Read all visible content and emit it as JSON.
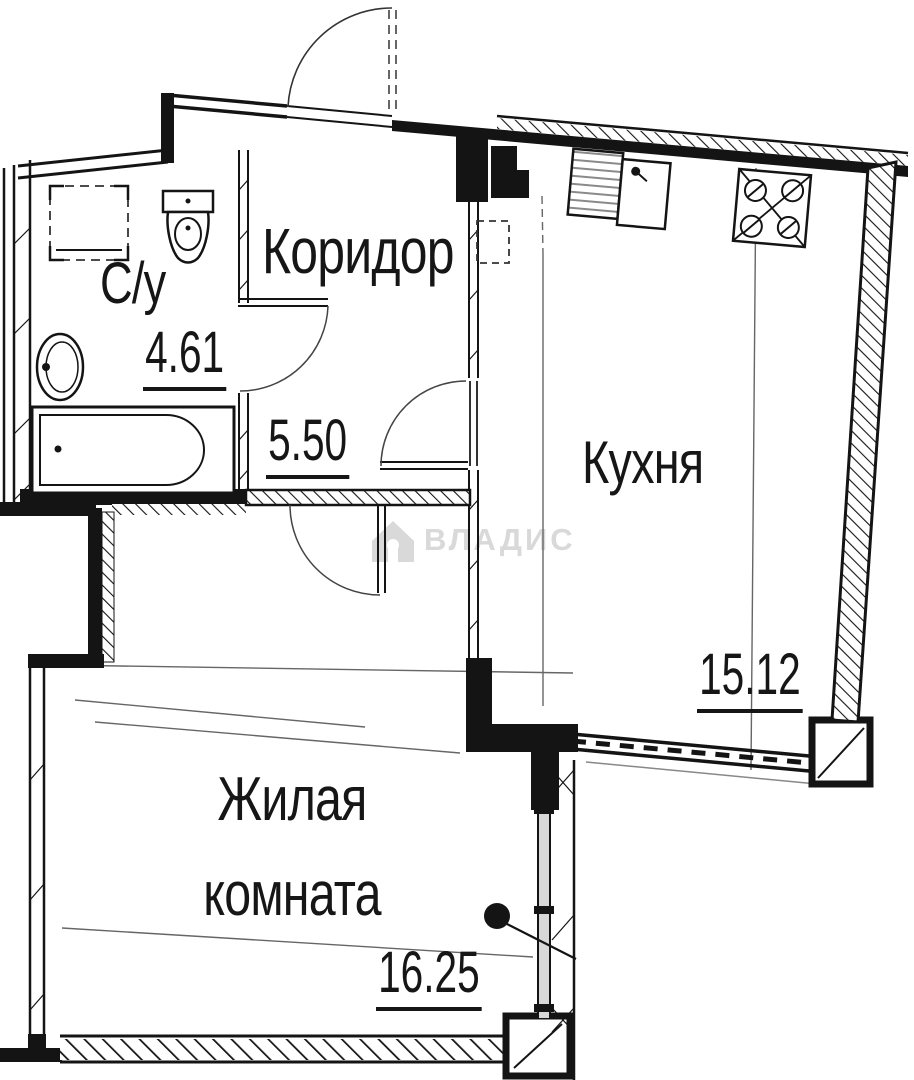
{
  "plan": {
    "title": "apartment-floor-plan",
    "rooms": {
      "bathroom": {
        "label": "С/у",
        "area": "4.61"
      },
      "corridor": {
        "label": "Коридор",
        "area": "5.50"
      },
      "kitchen": {
        "label": "Кухня",
        "area": "15.12"
      },
      "living_room": {
        "label": "Жилая комната",
        "area": "16.25"
      }
    },
    "fixtures": [
      "washing-machine-icon",
      "toilet-icon",
      "sink-icon",
      "bathtub-icon",
      "kitchen-sink-icon",
      "stove-icon"
    ],
    "doors": [
      "entrance-door",
      "bathroom-door",
      "kitchen-door",
      "hall-door"
    ],
    "watermark": {
      "text": "ВЛАДИС",
      "icon": "house-icon"
    },
    "colors": {
      "wall": "#141414",
      "thin_line": "#666666",
      "watermark": "#d9d9d9",
      "background": "#ffffff"
    }
  }
}
